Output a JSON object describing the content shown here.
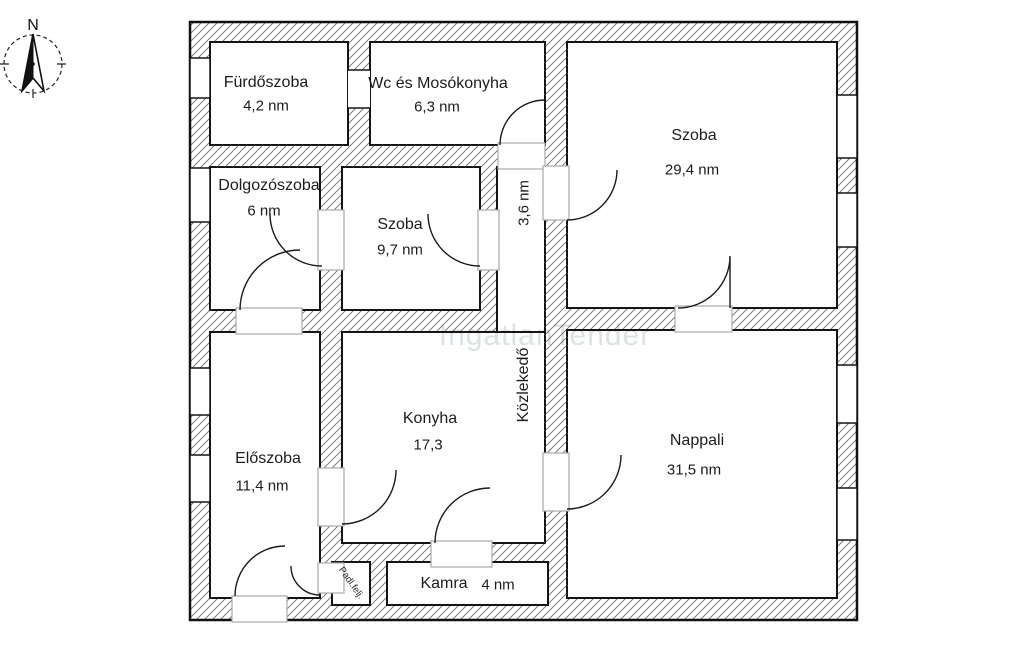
{
  "watermark": "IngatlanTender",
  "compass": {
    "north_label": "N"
  },
  "rooms": [
    {
      "id": "furdoszoba",
      "name": "Fürdőszoba",
      "area": "4,2 nm"
    },
    {
      "id": "wc-mosokonyha",
      "name": "Wc és Mosókonyha",
      "area": "6,3 nm"
    },
    {
      "id": "szoba-nagy",
      "name": "Szoba",
      "area": "29,4 nm"
    },
    {
      "id": "dolgozoszoba",
      "name": "Dolgozószoba",
      "area": "6 nm"
    },
    {
      "id": "szoba-kis",
      "name": "Szoba",
      "area": "9,7 nm"
    },
    {
      "id": "kozlekedo",
      "name": "Közlekedő",
      "area": "3,6 nm"
    },
    {
      "id": "konyha",
      "name": "Konyha",
      "area": "17,3"
    },
    {
      "id": "nappali",
      "name": "Nappali",
      "area": "31,5 nm"
    },
    {
      "id": "eloszoba",
      "name": "Előszoba",
      "area": "11,4 nm"
    },
    {
      "id": "kamra",
      "name": "Kamra",
      "area": "4 nm"
    },
    {
      "id": "padlas-feljaro",
      "name": "Padl.felj.",
      "area": ""
    }
  ],
  "colors": {
    "wall_line": "#151515",
    "hatch_line": "#6f6f6f",
    "door_leaf": "#a9a9a9",
    "watermark": "#dde3e0",
    "label_text": "#1c1c1c"
  }
}
